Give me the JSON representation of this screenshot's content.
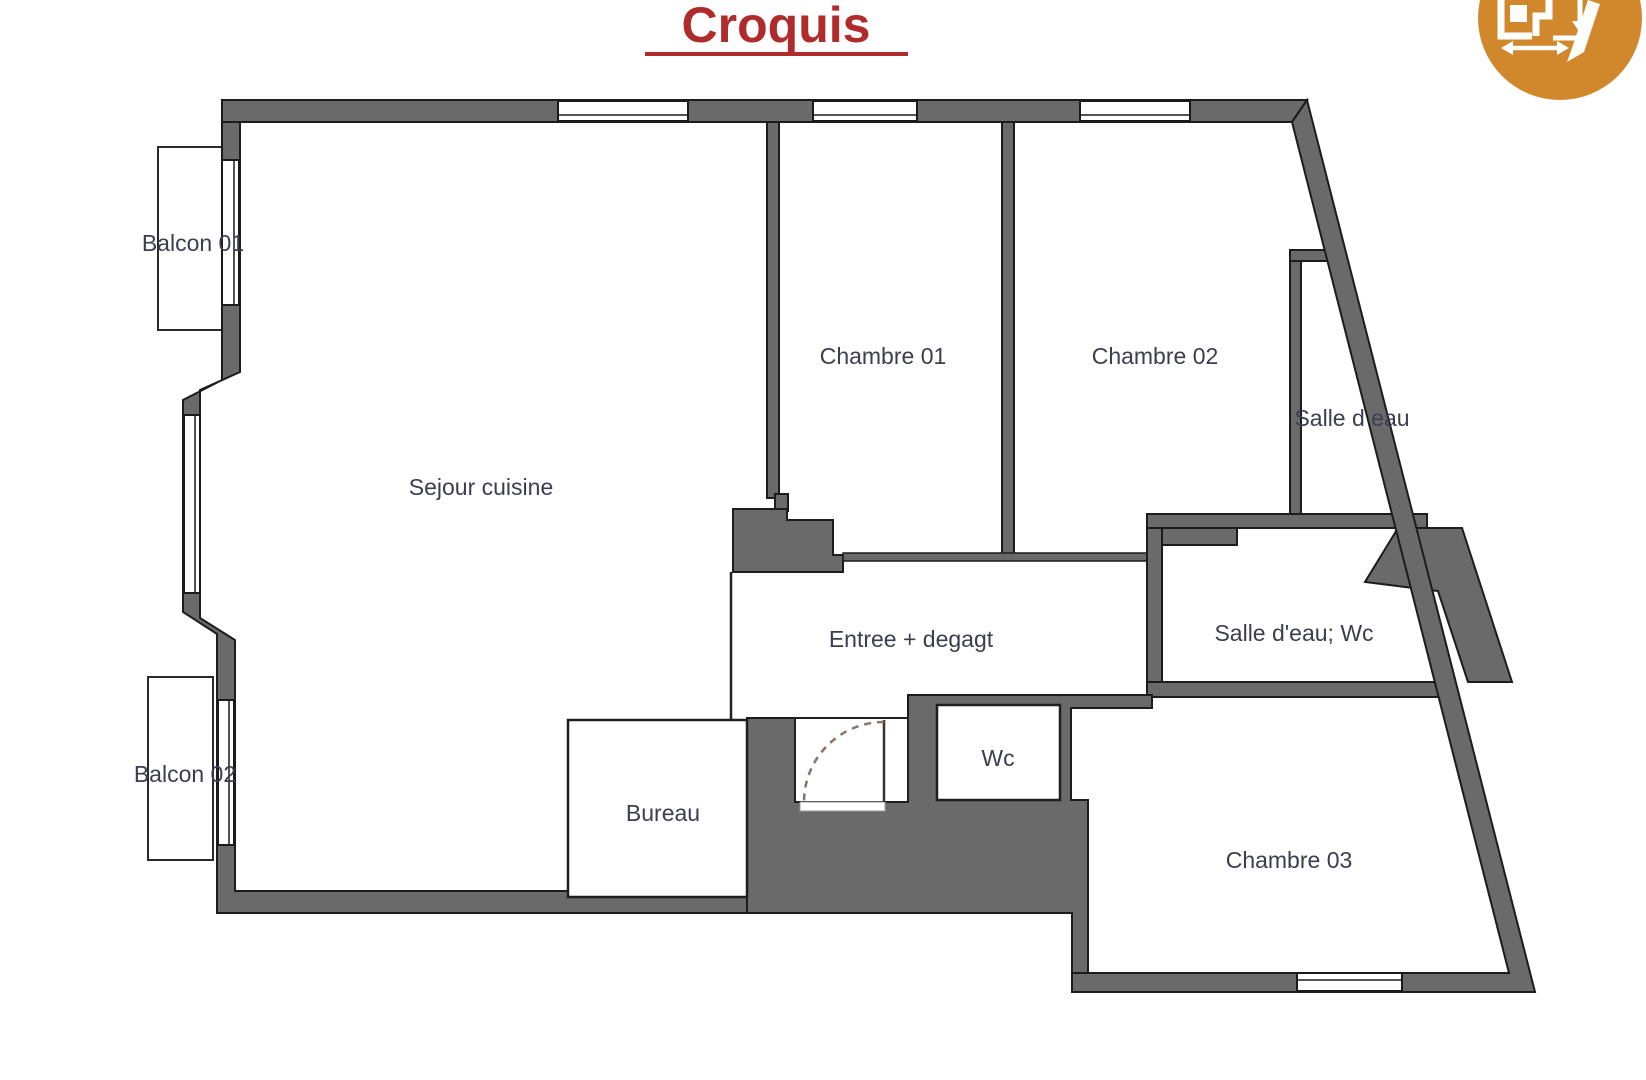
{
  "title": {
    "text": "Croquis"
  },
  "logo": {
    "name": "floorplan-measure-pencil-logo",
    "color": "#d1882d"
  },
  "colors": {
    "wall_fill": "#6a6a6a",
    "wall_outline": "#1c1c1c",
    "title_red": "#b02b2b",
    "label_color": "#3d3d50",
    "door_arc": "#85756a",
    "background": "#ffffff"
  },
  "rooms": {
    "balcon01": {
      "label": "Balcon 01"
    },
    "balcon02": {
      "label": "Balcon 02"
    },
    "sejour": {
      "label": "Sejour cuisine"
    },
    "chambre01": {
      "label": "Chambre 01"
    },
    "chambre02": {
      "label": "Chambre 02"
    },
    "salle_d_eau": {
      "label": "Salle d eau"
    },
    "salle_d_eau_wc": {
      "label": "Salle d'eau; Wc"
    },
    "entree": {
      "label": "Entree + degagt"
    },
    "bureau": {
      "label": "Bureau"
    },
    "wc": {
      "label": "Wc"
    },
    "chambre03": {
      "label": "Chambre 03"
    }
  }
}
